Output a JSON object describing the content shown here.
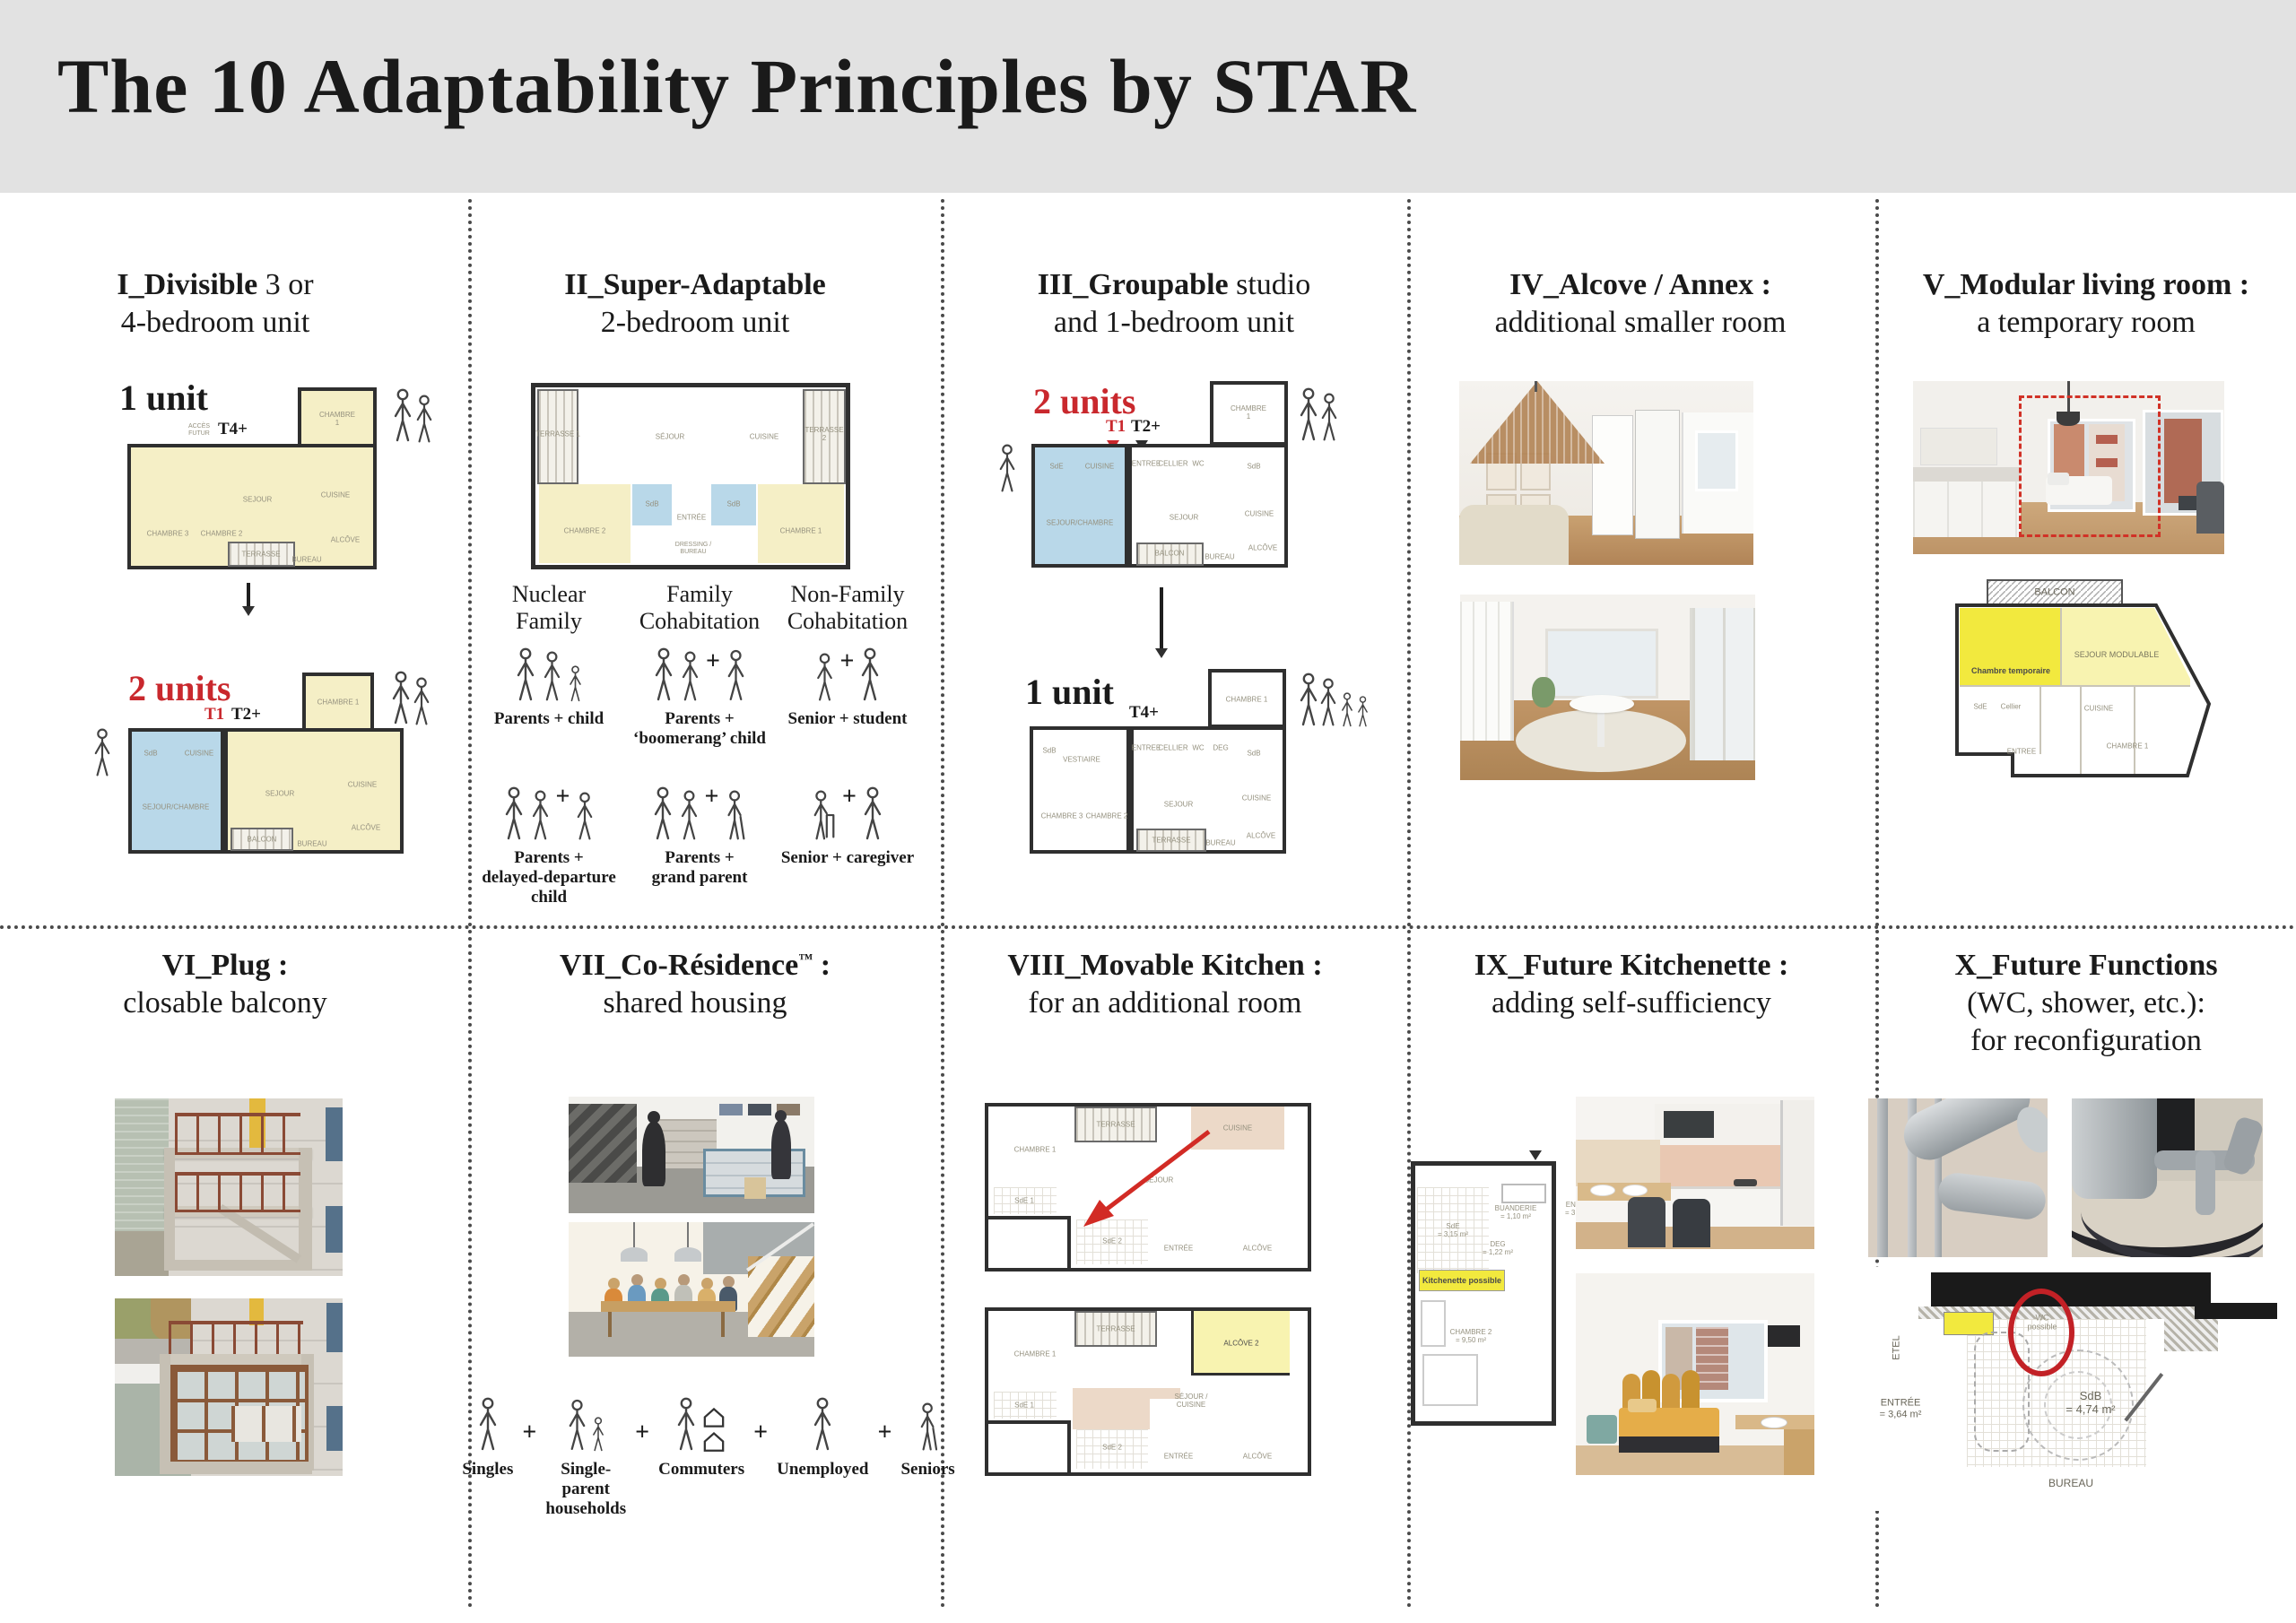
{
  "header": {
    "title": "The 10 Adaptability Principles by STAR"
  },
  "symbols": {
    "plus": "+"
  },
  "colors": {
    "accent_red": "#c9282d",
    "plan_yellow": "#f5efc6",
    "plan_blue": "#b9d8e9",
    "highlight_yellow": "#f2e93e",
    "header_bg": "#e2e2e2"
  },
  "panels": {
    "p1": {
      "t_b": "I_Divisible",
      "t_r": " 3 or",
      "t_l2": "4-bedroom unit",
      "unit1": "1 unit",
      "unit2": "2 units",
      "t4": "T4+",
      "t1": "T1",
      "t2": "T2+",
      "acces": "ACCÈS\nFUTUR",
      "rooms1": {
        "ch1": "CHAMBRE 1",
        "sej": "SEJOUR",
        "cui": "CUISINE",
        "alc": "ALCÔVE",
        "ter": "TERRASSE",
        "ch2": "CHAMBRE 2",
        "ch3": "CHAMBRE 3",
        "bur": "BUREAU"
      },
      "rooms2": {
        "sc": "SEJOUR/CHAMBRE",
        "sdb": "SdB",
        "cui": "CUISINE",
        "ch1": "CHAMBRE 1",
        "sej": "SEJOUR",
        "cui2": "CUISINE",
        "alc": "ALCÔVE",
        "bal": "BALCON",
        "bur": "BUREAU"
      }
    },
    "p2": {
      "t_b": "II_Super-Adaptable",
      "t_l2": "2-bedroom unit",
      "rooms": {
        "ter1": "TERRASSE 1",
        "sej": "SÉJOUR",
        "cui": "CUISINE",
        "ter2": "TERRASSE 2",
        "ch2": "CHAMBRE 2",
        "sdb": "SdB",
        "ent": "ENTRÉE",
        "sdb2": "SdB",
        "ch1": "CHAMBRE 1",
        "dre": "DRESSING /\nBUREAU"
      },
      "cols": [
        {
          "h": "Nuclear\nFamily",
          "c1": "Parents + child",
          "c2": "Parents +\ndelayed-departure child"
        },
        {
          "h": "Family\nCohabitation",
          "c1": "Parents +\n‘boomerang’ child",
          "c2": "Parents +\ngrand parent"
        },
        {
          "h": "Non-Family\nCohabitation",
          "c1": "Senior + student",
          "c2": "Senior + caregiver"
        }
      ]
    },
    "p3": {
      "t_b": "III_Groupable",
      "t_r": " studio",
      "t_l2": "and 1-bedroom unit",
      "unit2": "2 units",
      "unit1": "1 unit",
      "t1": "T1",
      "t2": "T2+",
      "t4": "T4+",
      "rooms1": {
        "sde": "SdE",
        "cui": "CUISINE",
        "sc": "SEJOUR/CHAMBRE",
        "ent": "ENTREE",
        "cel": "CELLIER",
        "wc": "WC",
        "sdb": "SdB",
        "sej": "SEJOUR",
        "cui2": "CUISINE",
        "alc": "ALCÔVE",
        "bal": "BALCON",
        "ch1": "CHAMBRE 1",
        "bur": "BUREAU"
      },
      "rooms2": {
        "ch2": "CHAMBRE 2",
        "ch3": "CHAMBRE 3",
        "ves": "VESTIAIRE",
        "sdb": "SdB",
        "ent": "ENTREE",
        "cel": "CELLIER",
        "wc": "WC",
        "deg": "DEG",
        "sdb2": "SdB",
        "sej": "SEJOUR",
        "cui": "CUISINE",
        "alc": "ALCÔVE",
        "ter": "TERRASSE",
        "bur": "BUREAU",
        "ch1": "CHAMBRE 1"
      }
    },
    "p4": {
      "t_b": "IV_Alcove / Annex :",
      "t_l2": "additional smaller room"
    },
    "p5": {
      "t_b": "V_Modular living room :",
      "t_l2": "a temporary room",
      "rooms": {
        "bal": "BALCON",
        "sm": "SEJOUR MODULABLE",
        "ct": "Chambre temporaire",
        "cui": "CUISINE",
        "ch1": "CHAMBRE 1",
        "ent": "ENTREE",
        "sde": "SdE",
        "cel": "Cellier"
      }
    },
    "p6": {
      "t_b": "VI_Plug :",
      "t_l2": "closable balcony"
    },
    "p7": {
      "t_b": "VII_Co-Résidence",
      "t_sup": "™",
      "t_b2": " :",
      "t_l2": "shared housing",
      "caps": [
        "Singles",
        "Single-parent\nhouseholds",
        "Commuters",
        "Unemployed",
        "Seniors"
      ]
    },
    "p8": {
      "t_b": "VIII_Movable Kitchen :",
      "t_l2": "for an additional room",
      "rooms1": {
        "ch1": "CHAMBRE 1",
        "ter": "TERRASSE",
        "cui": "CUISINE",
        "sej": "SÉJOUR",
        "sde1": "SdE 1",
        "sde2": "SdE 2",
        "ent": "ENTRÉE",
        "alc": "ALCÔVE"
      },
      "rooms2": {
        "ch1": "CHAMBRE 1",
        "ter": "TERRASSE",
        "alc2": "ALCÔVE 2",
        "sc": "SÉJOUR /\nCUISINE",
        "sde1": "SdE 1",
        "sde2": "SdE 2",
        "ent": "ENTRÉE",
        "alc": "ALCÔVE"
      }
    },
    "p9": {
      "t_b": "IX_Future Kitchenette :",
      "t_l2": "adding self-sufficiency",
      "rooms": {
        "kit": "Kitchenette possible",
        "bua": "BUANDERIE\n= 1,10 m²",
        "sde": "SdE\n= 3,15 m²",
        "deg": "DEG\n= 1,22 m²",
        "ent": "ENTRÉE\n= 3,04 m²",
        "ch2": "CHAMBRE 2\n= 9,50 m²"
      }
    },
    "p10": {
      "t_b": "X_Future Functions",
      "t_l2": "(WC, shower, etc.):",
      "t_l3": "for reconfiguration",
      "rooms": {
        "wc": "WC\npossible",
        "etel": "ETEL",
        "ent": "ENTRÉE\n= 3,64 m²",
        "sdb": "SdB\n= 4,74 m²",
        "bur": "BUREAU"
      }
    }
  }
}
